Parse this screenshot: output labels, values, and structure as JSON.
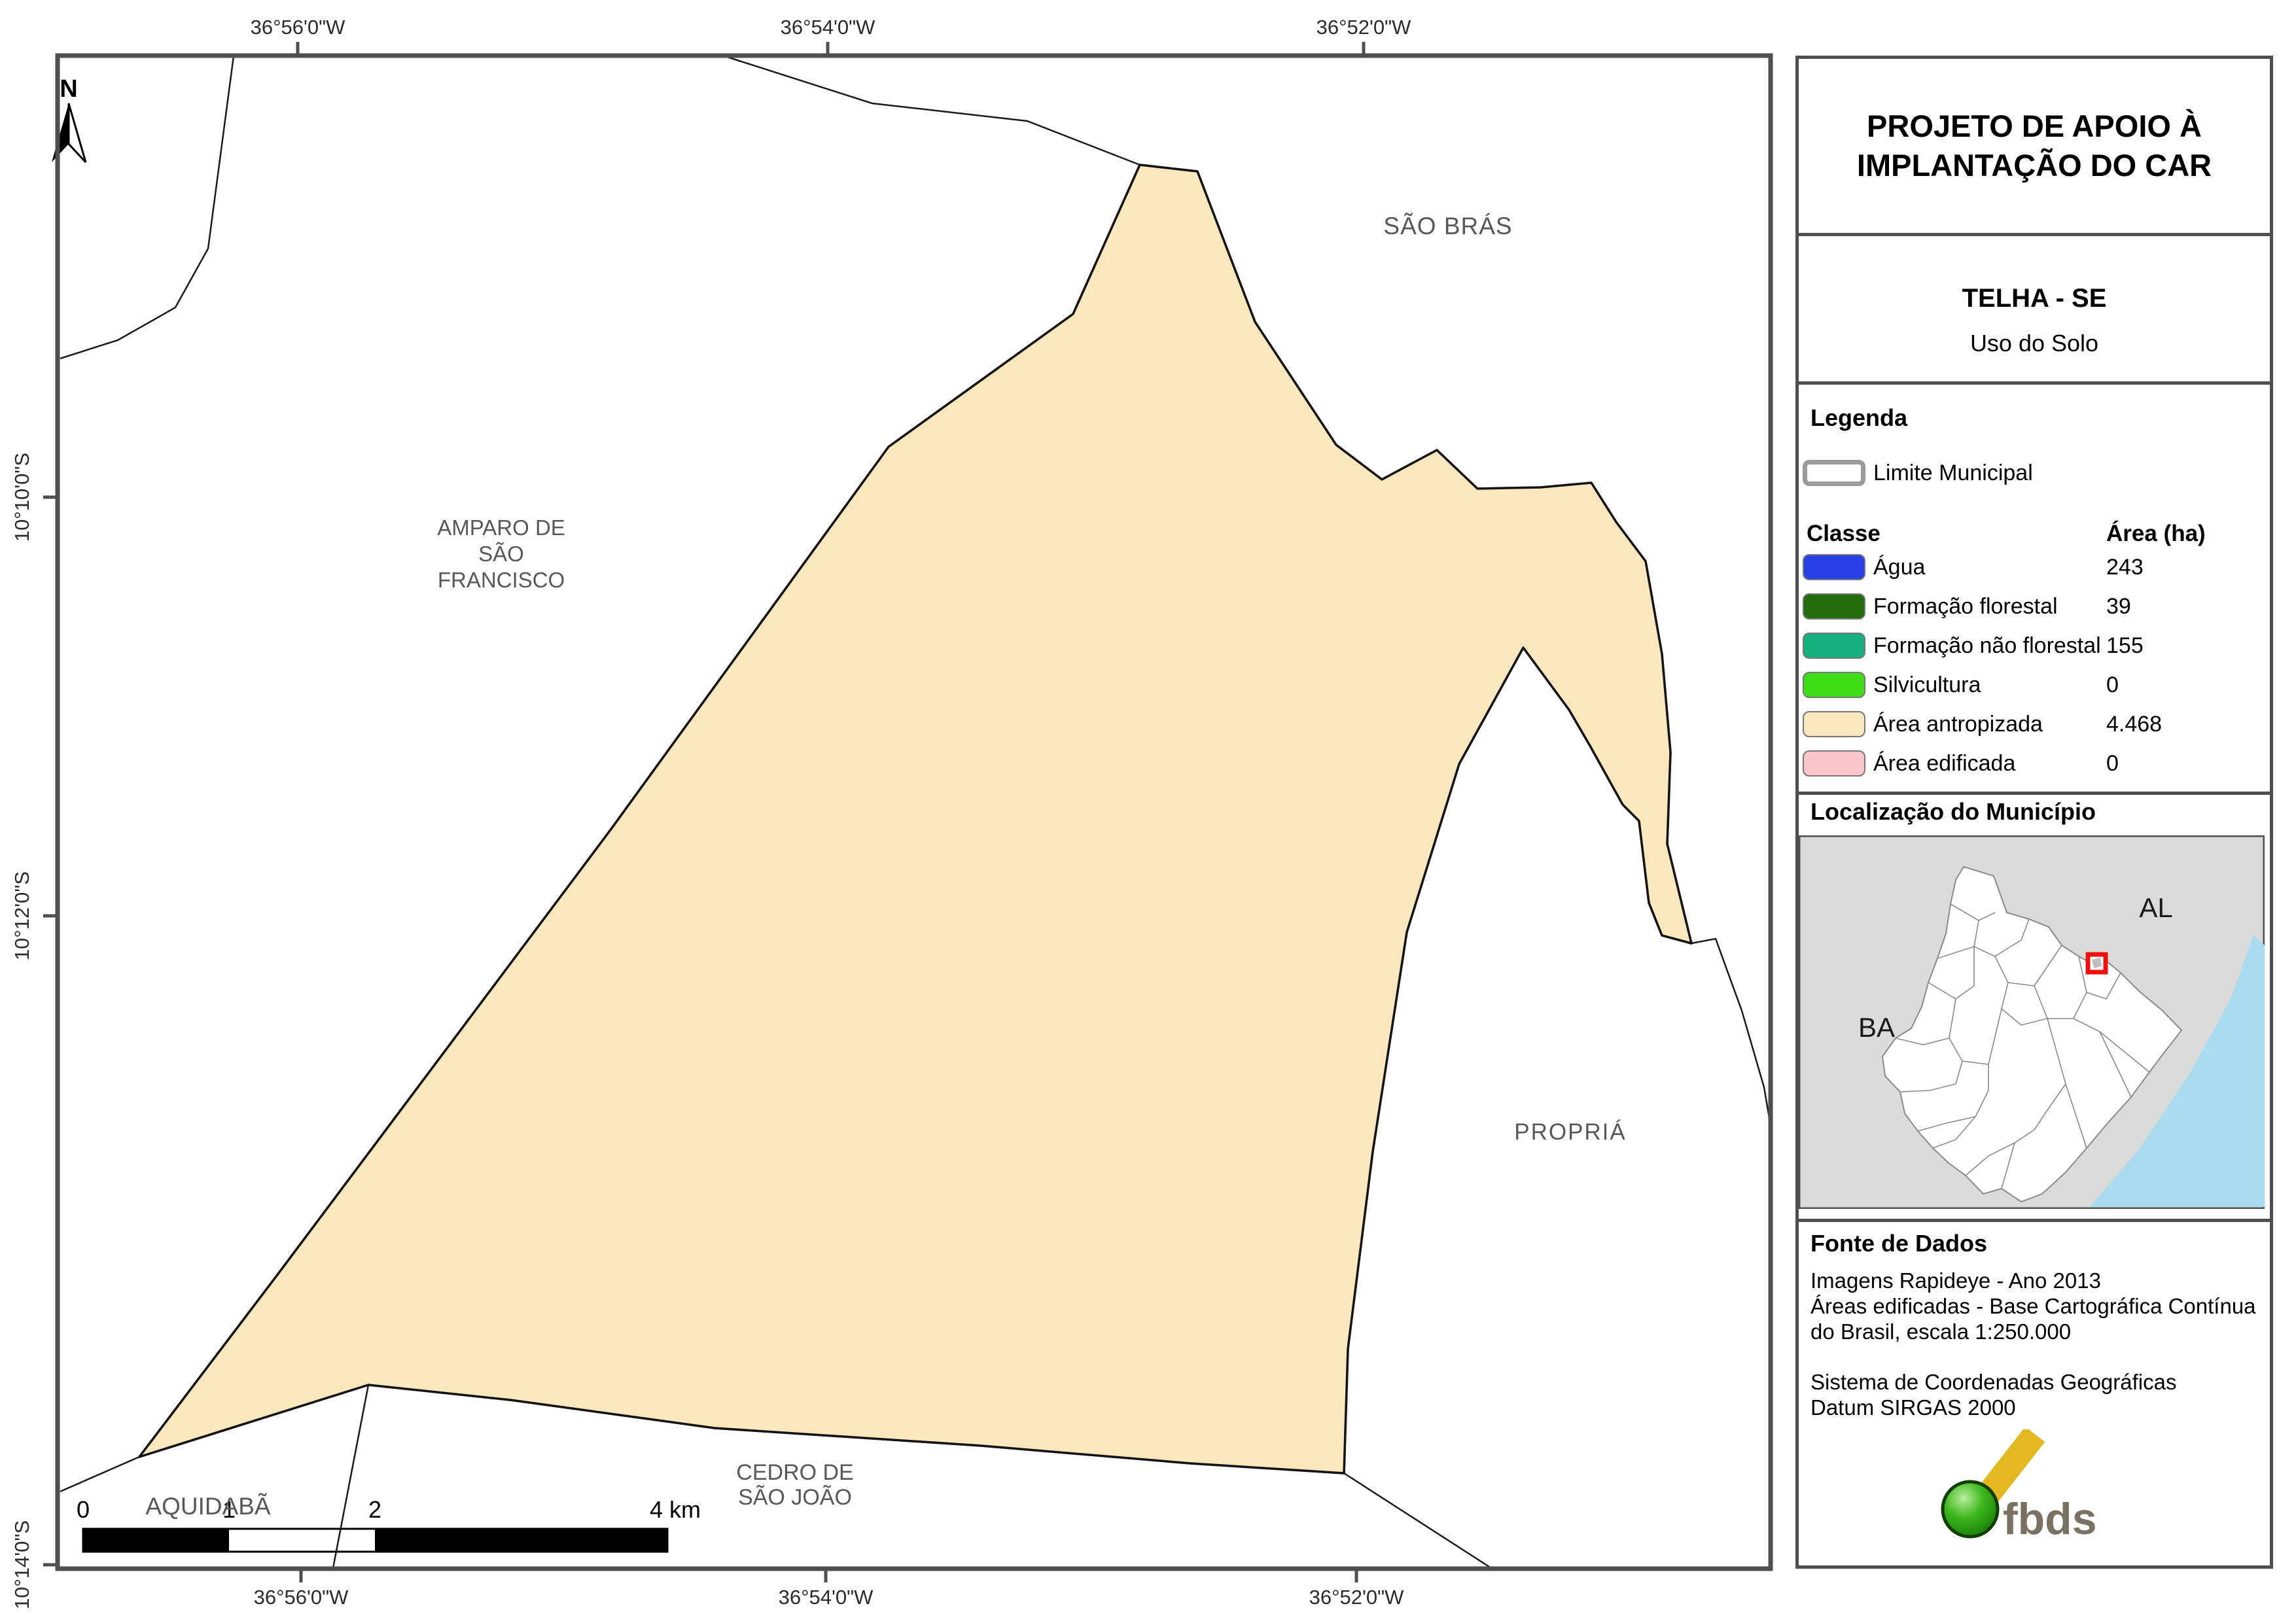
{
  "title": {
    "line1": "PROJETO DE APOIO À",
    "line2": "IMPLANTAÇÃO DO CAR"
  },
  "subtitle": {
    "municipality": "TELHA - SE",
    "map_type": "Uso do Solo"
  },
  "legend": {
    "heading": "Legenda",
    "limite_label": "Limite Municipal",
    "col_class": "Classe",
    "col_area": "Área (ha)",
    "classes": [
      {
        "label": "Água",
        "value": "243",
        "color": "#2840e8"
      },
      {
        "label": "Formação florestal",
        "value": "39",
        "color": "#256c0d"
      },
      {
        "label": "Formação não florestal",
        "value": "155",
        "color": "#14b07d"
      },
      {
        "label": "Silvicultura",
        "value": "0",
        "color": "#3fdd15"
      },
      {
        "label": "Área antropizada",
        "value": "4.468",
        "color": "#fae7be"
      },
      {
        "label": "Área edificada",
        "value": "0",
        "color": "#fac6cb"
      }
    ]
  },
  "inset": {
    "heading": "Localização do Município",
    "label_al": "AL",
    "label_ba": "BA"
  },
  "source": {
    "heading": "Fonte de Dados",
    "line1": "Imagens Rapideye - Ano 2013",
    "line2": "Áreas edificadas - Base Cartográfica Contínua",
    "line3": "do Brasil, escala 1:250.000",
    "line4": "Sistema de Coordenadas Geográficas",
    "line5": "Datum SIRGAS 2000"
  },
  "logo": {
    "text": "fbds"
  },
  "map": {
    "north_label": "N",
    "lon_ticks": [
      "36°56'0\"W",
      "36°54'0\"W",
      "36°52'0\"W"
    ],
    "lat_ticks": [
      "10°10'0\"S",
      "10°12'0\"S",
      "10°14'0\"S"
    ],
    "scalebar_labels": [
      "0",
      "1",
      "2",
      "4 km"
    ],
    "place_labels": {
      "sao_bras": "SÃO BRÁS",
      "amparo": [
        "AMPARO DE",
        "SÃO",
        "FRANCISCO"
      ],
      "propria": "PROPRIÁ",
      "aquidaba": "AQUIDABÃ",
      "cedro": [
        "CEDRO DE",
        "SÃO JOÃO"
      ]
    }
  },
  "colors": {
    "agua": "#2840e8",
    "florestal": "#256c0d",
    "nao_florestal": "#14b07d",
    "antropizada": "#fae7be",
    "frame": "#4f4f4f",
    "boundary": "#141414",
    "label_gray": "#585858",
    "inset_bg": "#dbdbdb",
    "inset_ocean": "#a9dcef",
    "marker_red": "#ee1111"
  }
}
